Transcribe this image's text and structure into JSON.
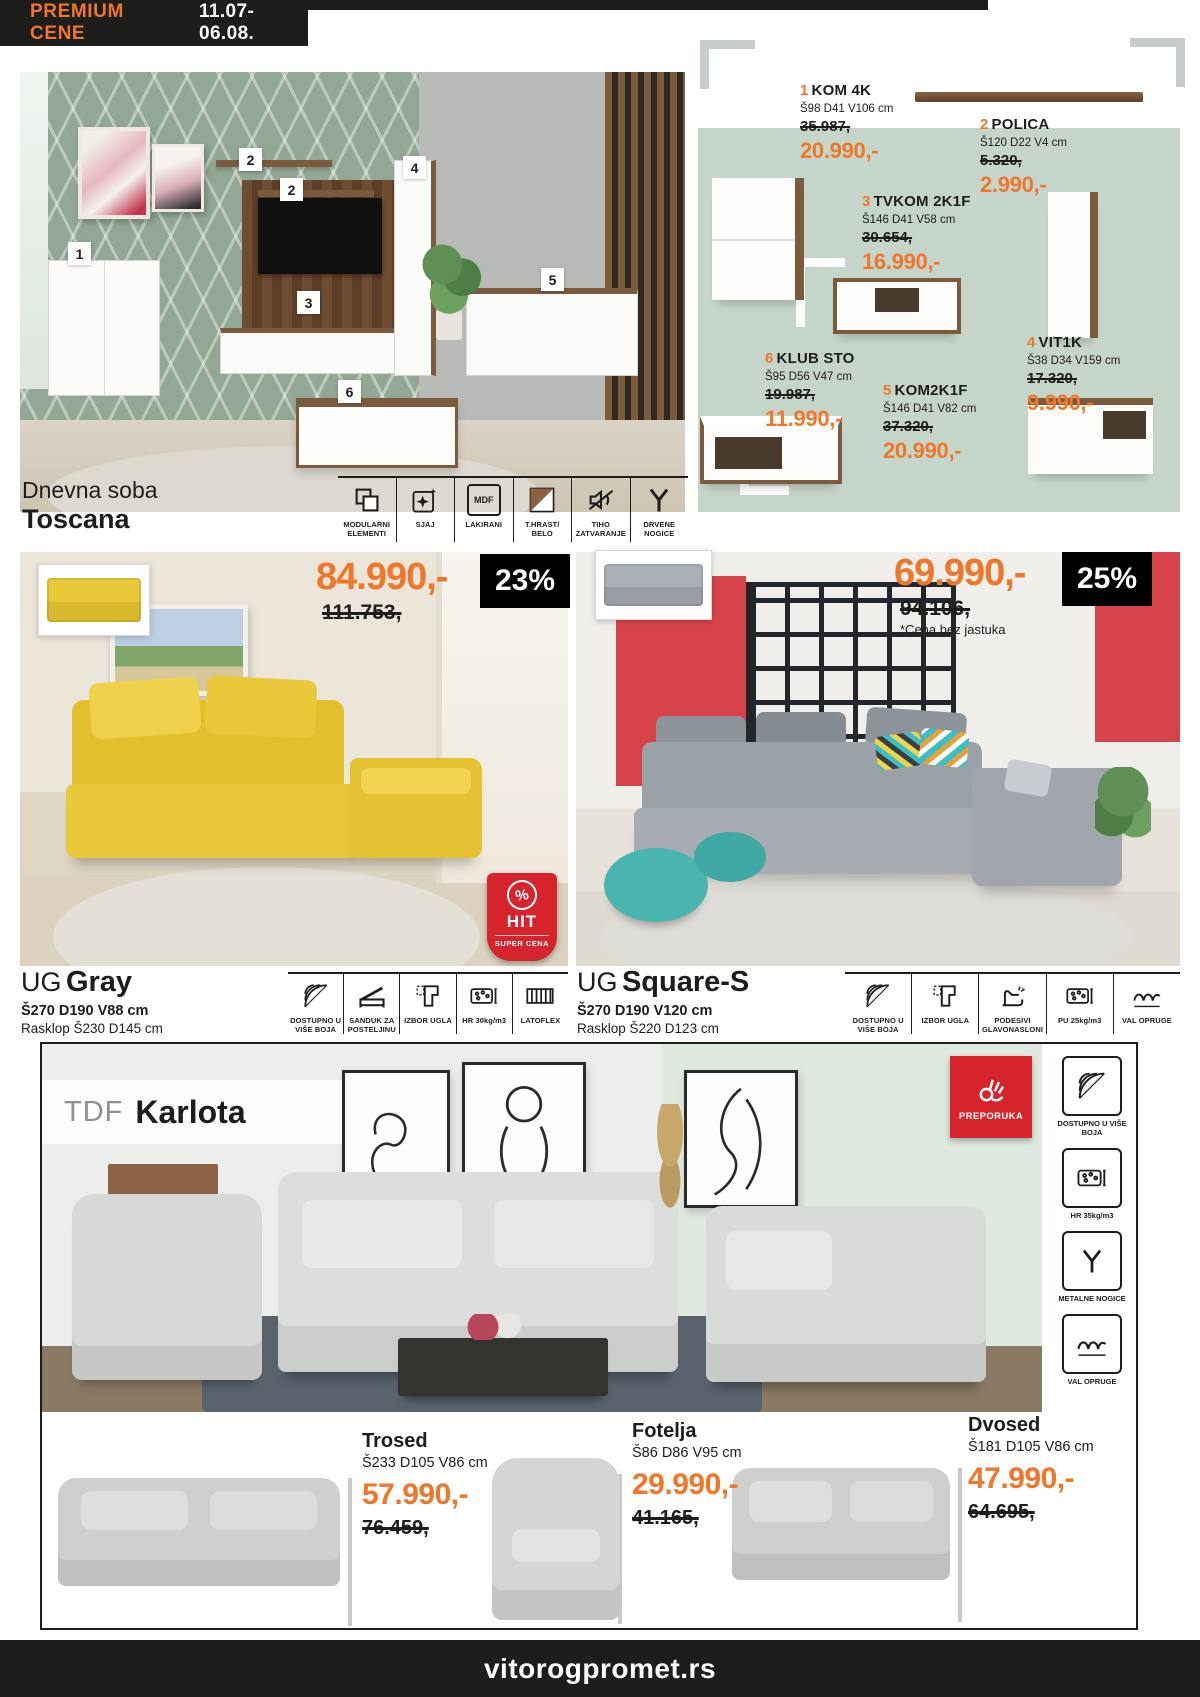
{
  "colors": {
    "accent_orange": "#f0762a",
    "dark": "#1d1d1b",
    "sage_panel": "#c5d5c9",
    "badge_red": "#d6242c"
  },
  "header": {
    "badge_title": "PREMIUM CENE",
    "date_range": "11.07-06.08."
  },
  "toscana": {
    "caption_top": "Dnevna soba",
    "caption_name": "Toscana",
    "mdf_icon_text": "MDF",
    "room_tags": [
      {
        "n": "1"
      },
      {
        "n": "2"
      },
      {
        "n": "2"
      },
      {
        "n": "3"
      },
      {
        "n": "4"
      },
      {
        "n": "5"
      },
      {
        "n": "6"
      }
    ],
    "products": [
      {
        "num": "1",
        "name": "KOM 4K",
        "dims": "Š98 D41 V106 cm",
        "old": "35.987,",
        "price": "20.990,-"
      },
      {
        "num": "2",
        "name": "POLICA",
        "dims": "Š120 D22 V4 cm",
        "old": "5.320,",
        "price": "2.990,-"
      },
      {
        "num": "3",
        "name": "TVKOM 2K1F",
        "dims": "Š146 D41 V58 cm",
        "old": "30.654,",
        "price": "16.990,-"
      },
      {
        "num": "4",
        "name": "VIT1K",
        "dims": "Š38 D34 V159 cm",
        "old": "17.320,",
        "price": "9.990,-"
      },
      {
        "num": "5",
        "name": "KOM2K1F",
        "dims": "Š146 D41 V82 cm",
        "old": "37.320,",
        "price": "20.990,-"
      },
      {
        "num": "6",
        "name": "KLUB STO",
        "dims": "Š95 D56 V47 cm",
        "old": "19.987,",
        "price": "11.990,-"
      }
    ],
    "features": [
      {
        "label": "MODULARNI ELEMENTI"
      },
      {
        "label": "SJAJ"
      },
      {
        "label": "LAKIRANI"
      },
      {
        "label": "T.HRAST/ BELO"
      },
      {
        "label": "TIHO ZATVARANJE"
      },
      {
        "label": "DRVENE NOGICE"
      }
    ]
  },
  "ug_gray": {
    "price": "84.990,-",
    "old_price": "111.753,",
    "discount": "23%",
    "brand": "UG",
    "name": "Gray",
    "dims": "Š270 D190 V88 cm",
    "fold": "Rasklop Š230 D145 cm",
    "hit_badge": {
      "percent": "%",
      "word": "HIT",
      "sub": "SUPER CENA"
    },
    "features": [
      {
        "label": "DOSTUPNO U VIŠE BOJA"
      },
      {
        "label": "SANDUK ZA POSTELJINU"
      },
      {
        "label": "IZBOR UGLA"
      },
      {
        "label": "HR 30kg/m3"
      },
      {
        "label": "LATOFLEX"
      }
    ]
  },
  "ug_square": {
    "price": "69.990,-",
    "old_price": "94.106,",
    "note": "*Cena bez jastuka",
    "discount": "25%",
    "brand": "UG",
    "name": "Square-S",
    "dims": "Š270 D190 V120 cm",
    "fold": "Rasklop Š220 D123 cm",
    "features": [
      {
        "label": "DOSTUPNO U VIŠE BOJA"
      },
      {
        "label": "IZBOR UGLA"
      },
      {
        "label": "PODESIVI GLAVONASLONI"
      },
      {
        "label": "PU 25kg/m3"
      },
      {
        "label": "VAL OPRUGE"
      }
    ]
  },
  "karlota": {
    "brand": "TDF",
    "name": "Karlota",
    "badge": "PREPORUKA",
    "features": [
      {
        "label": "DOSTUPNO U VIŠE BOJA"
      },
      {
        "label": "HR 35kg/m3"
      },
      {
        "label": "METALNE NOGICE"
      },
      {
        "label": "VAL OPRUGE"
      }
    ],
    "items": [
      {
        "name": "Trosed",
        "dims": "Š233 D105 V86 cm",
        "price": "57.990,-",
        "old": "76.459,"
      },
      {
        "name": "Fotelja",
        "dims": "Š86 D86 V95 cm",
        "price": "29.990,-",
        "old": "41.165,"
      },
      {
        "name": "Dvosed",
        "dims": "Š181 D105 V86 cm",
        "price": "47.990,-",
        "old": "64.695,"
      }
    ]
  },
  "footer": {
    "site": "vitorogpromet.rs"
  }
}
